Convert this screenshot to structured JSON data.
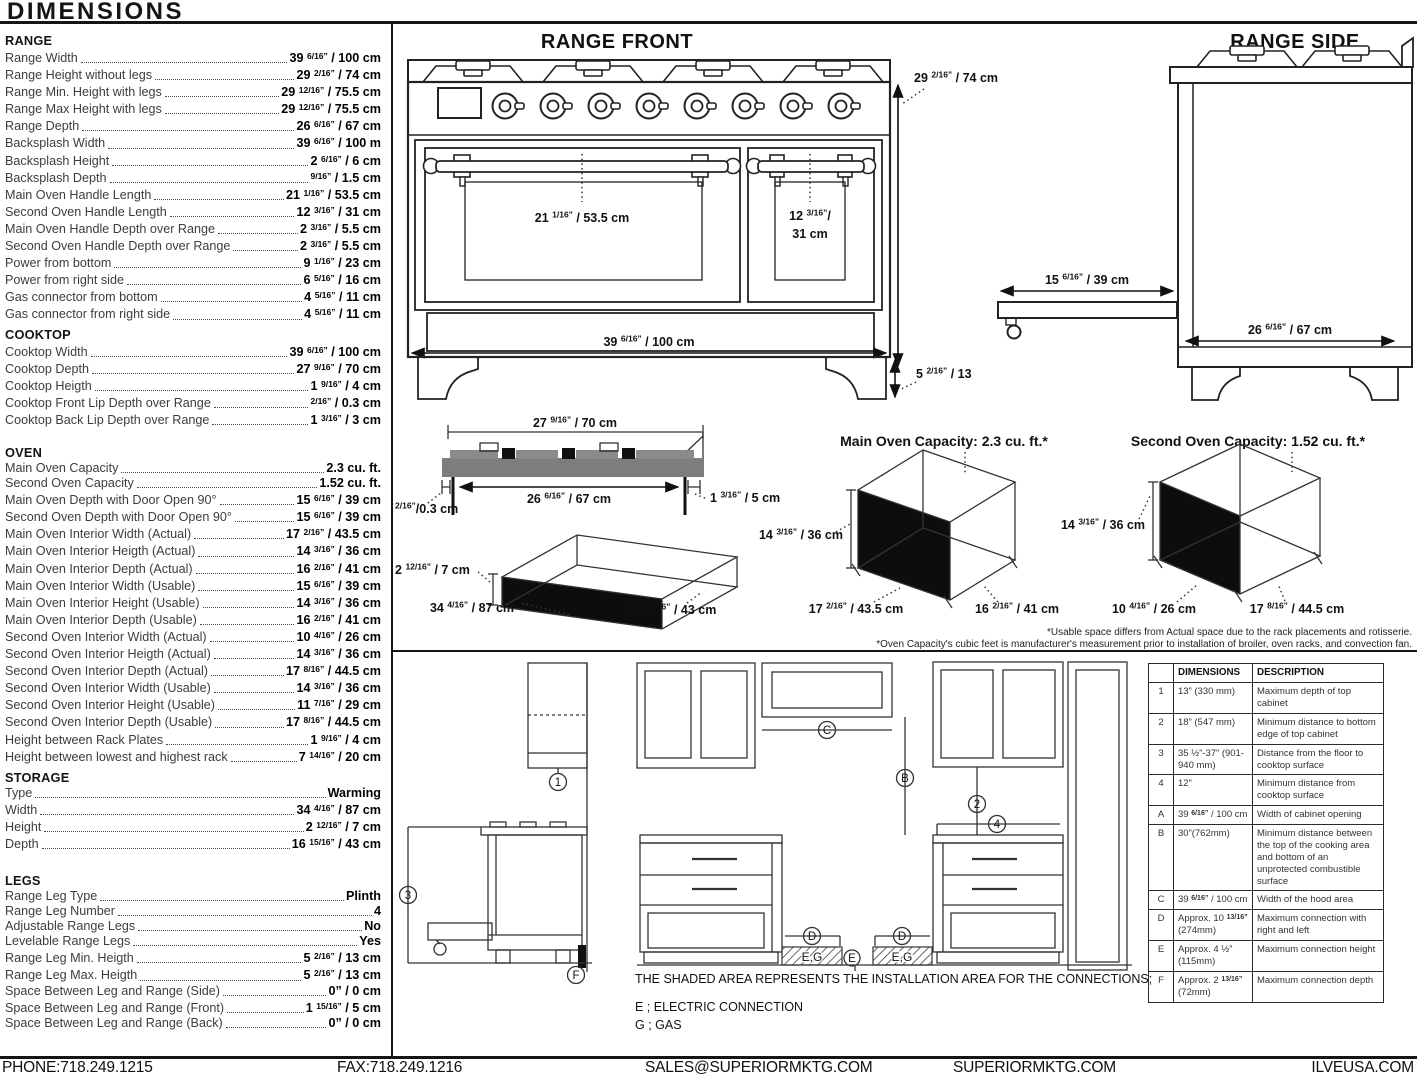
{
  "page": {
    "title": "DIMENSIONS"
  },
  "specs": {
    "range": {
      "heading": "RANGE",
      "rows": [
        {
          "label": "Range Width",
          "value": "39 6/16” / 100 cm"
        },
        {
          "label": "Range Height without legs",
          "value": "29 2/16” / 74 cm"
        },
        {
          "label": "Range Min. Height with legs",
          "value": "29 12/16” / 75.5 cm"
        },
        {
          "label": "Range Max Height with legs",
          "value": "29 12/16” / 75.5 cm"
        },
        {
          "label": "Range Depth",
          "value": "26 6/16” / 67 cm"
        },
        {
          "label": "Backsplash Width",
          "value": "39 6/16” / 100 m"
        },
        {
          "label": "Backsplash Height",
          "value": "2 6/16” / 6 cm"
        },
        {
          "label": "Backsplash Depth",
          "value": "9/16” / 1.5 cm"
        },
        {
          "label": "Main Oven Handle Length",
          "value": "21 1/16” / 53.5 cm"
        },
        {
          "label": "Second Oven Handle Length",
          "value": "12 3/16” / 31 cm"
        },
        {
          "label": "Main Oven Handle Depth over Range",
          "value": "2 3/16” / 5.5 cm"
        },
        {
          "label": "Second Oven Handle Depth over Range",
          "value": "2 3/16” / 5.5 cm"
        },
        {
          "label": "Power from bottom",
          "value": "9 1/16” / 23 cm"
        },
        {
          "label": "Power from right side",
          "value": "6 5/16” / 16 cm"
        },
        {
          "label": "Gas connector from bottom",
          "value": "4 5/16” / 11 cm"
        },
        {
          "label": "Gas connector from right side",
          "value": "4 5/16” / 11 cm"
        }
      ]
    },
    "cooktop": {
      "heading": "COOKTOP",
      "rows": [
        {
          "label": "Cooktop Width",
          "value": "39 6/16” / 100 cm"
        },
        {
          "label": "Cooktop Depth",
          "value": "27 9/16” / 70 cm"
        },
        {
          "label": "Cooktop Heigth",
          "value": "1 9/16” / 4 cm"
        },
        {
          "label": "Cooktop Front Lip Depth over Range",
          "value": "2/16” / 0.3 cm"
        },
        {
          "label": "Cooktop Back Lip Depth over Range",
          "value": "1 3/16” / 3 cm"
        }
      ]
    },
    "oven": {
      "heading": "OVEN",
      "rows": [
        {
          "label": "Main Oven Capacity",
          "value": "2.3 cu. ft."
        },
        {
          "label": "Second Oven Capacity",
          "value": "1.52 cu. ft."
        },
        {
          "label": "Main Oven Depth with Door Open 90°",
          "value": "15 6/16” / 39 cm"
        },
        {
          "label": "Second Oven Depth with Door Open 90°",
          "value": "15 6/16” / 39 cm"
        },
        {
          "label": "Main Oven Interior Width (Actual)",
          "value": "17 2/16” / 43.5 cm"
        },
        {
          "label": "Main Oven Interior Heigth (Actual)",
          "value": "14 3/16” / 36 cm"
        },
        {
          "label": "Main Oven Interior Depth (Actual)",
          "value": "16 2/16” / 41 cm"
        },
        {
          "label": "Main Oven Interior Width (Usable)",
          "value": "15 6/16” / 39 cm"
        },
        {
          "label": "Main Oven Interior Height (Usable)",
          "value": "14 3/16” / 36 cm"
        },
        {
          "label": "Main Oven Interior Depth (Usable)",
          "value": "16 2/16” / 41 cm"
        },
        {
          "label": "Second Oven Interior Width (Actual)",
          "value": "10 4/16” / 26 cm"
        },
        {
          "label": "Second Oven Interior Heigth (Actual)",
          "value": "14 3/16” / 36 cm"
        },
        {
          "label": "Second Oven Interior Depth (Actual)",
          "value": "17 8/16” / 44.5 cm"
        },
        {
          "label": "Second Oven Interior Width (Usable)",
          "value": "14 3/16” / 36 cm"
        },
        {
          "label": "Second Oven Interior Height (Usable)",
          "value": "11 7/16” / 29 cm"
        },
        {
          "label": "Second Oven Interior Depth (Usable)",
          "value": "17 8/16” / 44.5 cm"
        },
        {
          "label": "Height between Rack Plates",
          "value": "1 9/16” / 4 cm"
        },
        {
          "label": "Height between lowest and highest rack",
          "value": "7 14/16” / 20 cm"
        }
      ]
    },
    "storage": {
      "heading": "STORAGE",
      "rows": [
        {
          "label": "Type",
          "value": "Warming"
        },
        {
          "label": "Width",
          "value": "34 4/16” / 87 cm"
        },
        {
          "label": "Height",
          "value": "2 12/16” / 7 cm"
        },
        {
          "label": "Depth",
          "value": "16 15/16” / 43 cm"
        }
      ]
    },
    "legs": {
      "heading": "LEGS",
      "rows": [
        {
          "label": "Range Leg Type",
          "value": "Plinth"
        },
        {
          "label": "Range Leg Number",
          "value": "4"
        },
        {
          "label": "Adjustable Range Legs",
          "value": "No"
        },
        {
          "label": "Levelable Range Legs",
          "value": "Yes"
        },
        {
          "label": "Range Leg Min. Heigth",
          "value": "5 2/16” / 13 cm"
        },
        {
          "label": "Range Leg Max. Heigth",
          "value": "5 2/16” / 13 cm"
        },
        {
          "label": "Space Between Leg and Range (Side)",
          "value": "0” / 0 cm"
        },
        {
          "label": "Space Between Leg and Range (Front)",
          "value": "1 15/16” / 5 cm"
        },
        {
          "label": "Space Between Leg and Range (Back)",
          "value": "0” / 0 cm"
        }
      ]
    }
  },
  "front": {
    "title": "RANGE FRONT",
    "height": "29 2/16” / 74 cm",
    "width": "39 6/16” / 100 cm",
    "main_handle": "21 1/16” / 53.5 cm",
    "second_handle_1": "12 3/16”/",
    "second_handle_2": "31 cm",
    "leg_height": "5 2/16” / 13"
  },
  "side": {
    "title": "RANGE SIDE",
    "door_open": "15 6/16” / 39 cm",
    "depth": "26 6/16” / 67 cm"
  },
  "cooktop_fig": {
    "width_top": "27 9/16” / 70 cm",
    "width_inner": "26 6/16” / 67 cm",
    "front_lip": "2/16”/0.3 cm",
    "back_lip": "1 3/16” / 5 cm"
  },
  "storage_fig": {
    "height": "2 12/16” / 7 cm",
    "width": "34 4/16” / 87 cm",
    "depth": "16 15/16” / 43 cm"
  },
  "main_oven_fig": {
    "title": "Main Oven Capacity: 2.3 cu. ft.*",
    "height": "14 3/16” / 36 cm",
    "width": "17 2/16” / 43.5 cm",
    "depth": "16 2/16” / 41 cm"
  },
  "second_oven_fig": {
    "title": "Second Oven Capacity: 1.52 cu. ft.*",
    "height": "14 3/16” / 36 cm",
    "width": "10 4/16” / 26 cm",
    "depth": "17 8/16” / 44.5 cm"
  },
  "footnotes": [
    "*Usable space differs from Actual space due to the rack placements and rotisserie.",
    "*Oven Capacity's cubic feet is manufacturer's measurement prior to installation of broiler, oven racks, and convection fan."
  ],
  "installation": {
    "note": "THE SHADED AREA REPRESENTS THE INSTALLATION AREA FOR THE CONNECTIONS;",
    "legend": [
      {
        "label": "E ; ELECTRIC CONNECTION"
      },
      {
        "label": "G ; GAS"
      }
    ],
    "zone_label": "E,G",
    "table": {
      "headers": [
        "",
        "DIMENSIONS",
        "DESCRIPTION"
      ],
      "rows": [
        {
          "id": "1",
          "dim": "13” (330 mm)",
          "desc": "Maximum depth of top cabinet"
        },
        {
          "id": "2",
          "dim": "18” (547 mm)",
          "desc": "Minimum distance to bottom edge of top cabinet"
        },
        {
          "id": "3",
          "dim": "35 ½”-37” (901-940 mm)",
          "desc": "Distance from the floor to cooktop surface"
        },
        {
          "id": "4",
          "dim": "12”",
          "desc": "Minimum distance from cooktop surface"
        },
        {
          "id": "A",
          "dim": "39 6/16” / 100 cm",
          "desc": "Width of cabinet opening"
        },
        {
          "id": "B",
          "dim": "30”(762mm)",
          "desc": "Minimum distance between the top of the cooking area and bottom of an unprotected combustible surface"
        },
        {
          "id": "C",
          "dim": "39 6/16” / 100 cm",
          "desc": "Width of the hood area"
        },
        {
          "id": "D",
          "dim": "Approx. 10 13/16” (274mm)",
          "desc": "Maximum connection with right and left"
        },
        {
          "id": "E",
          "dim": "Approx. 4 ½” (115mm)",
          "desc": "Maximum connection height"
        },
        {
          "id": "F",
          "dim": "Approx. 2 13/16” (72mm)",
          "desc": "Maximum connection depth"
        }
      ]
    }
  },
  "footer": {
    "phone": "PHONE:718.249.1215",
    "fax": "FAX:718.249.1216",
    "email": "SALES@SUPERIORMKTG.COM",
    "site": "SUPERIORMKTG.COM",
    "brand": "ILVEUSA.COM"
  }
}
